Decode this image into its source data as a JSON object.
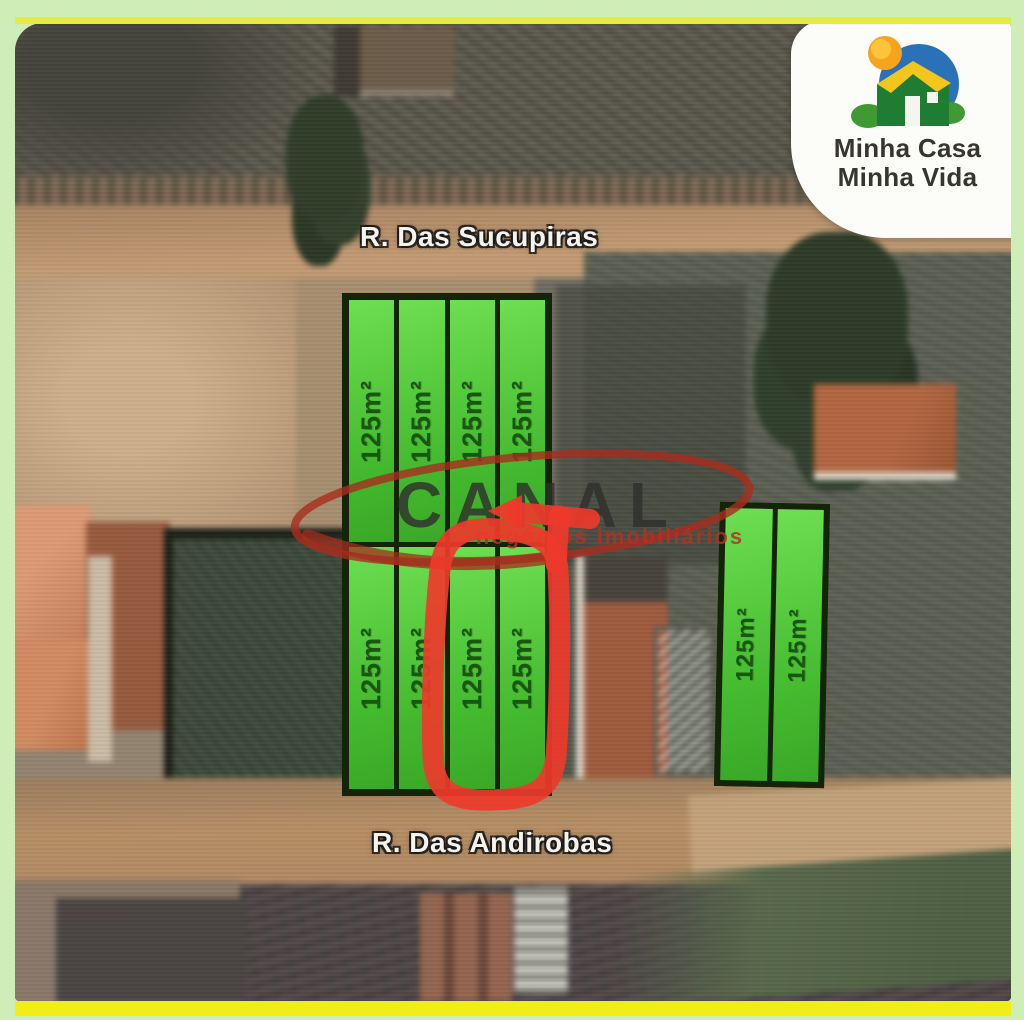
{
  "image": {
    "type": "aerial-lot-map-advert"
  },
  "program_badge": {
    "line1": "Minha Casa",
    "line2": "Minha Vida",
    "icon": "minha-casa-minha-vida-house-logo"
  },
  "streets": {
    "top": "R. Das Sucupiras",
    "bottom": "R. Das Andirobas"
  },
  "watermark": {
    "name": "CANAL",
    "tagline": "negócios imobiliários"
  },
  "lots": {
    "area_label": "125m²",
    "north_row_count": 4,
    "south_row_count": 4,
    "east_block_count": 2
  },
  "annotation": {
    "shape": "hand-drawn circle with arrow",
    "color": "#ee392b"
  },
  "colors": {
    "frame_green": "#cfeeb7",
    "frame_yellow": "#f1ee15",
    "lot_green": "#4ec636",
    "lot_border": "#132409",
    "lot_text": "#19560f"
  }
}
